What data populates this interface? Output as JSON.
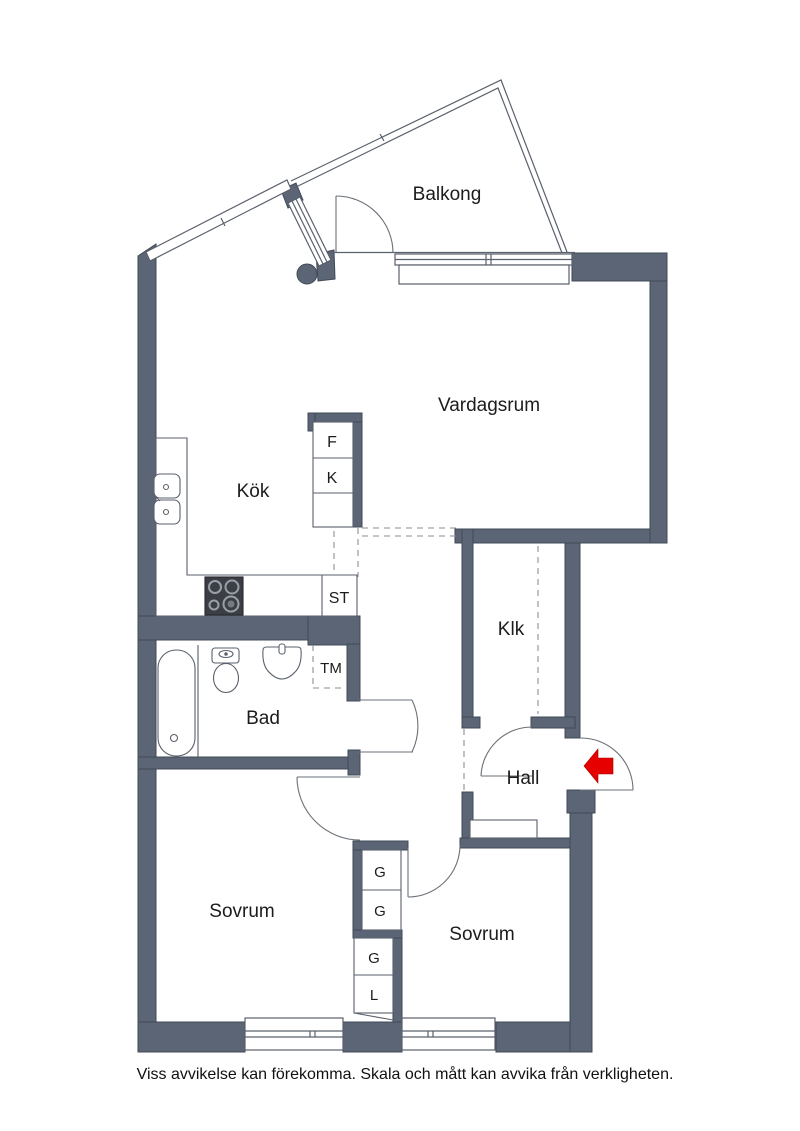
{
  "plan": {
    "title_note": "Viss avvikelse kan förekomma. Skala och mått kan avvika från verkligheten.",
    "colors": {
      "wall": "#5c6575",
      "wall_outline": "#414957",
      "line": "#5a616c",
      "arrow": "#e60000",
      "text": "#1c1c1c"
    },
    "rooms": {
      "balcony": {
        "label": "Balkong"
      },
      "living": {
        "label": "Vardagsrum"
      },
      "kitchen": {
        "label": "Kök"
      },
      "closet": {
        "label": "Klk"
      },
      "bath": {
        "label": "Bad"
      },
      "hall": {
        "label": "Hall"
      },
      "bedroom1": {
        "label": "Sovrum"
      },
      "bedroom2": {
        "label": "Sovrum"
      }
    },
    "fixtures": {
      "fridge": "F",
      "freezer": "K",
      "st": "ST",
      "washer": "TM",
      "wardrobe1": "G",
      "wardrobe2": "G",
      "wardrobe3": "G",
      "linen": "L"
    }
  }
}
